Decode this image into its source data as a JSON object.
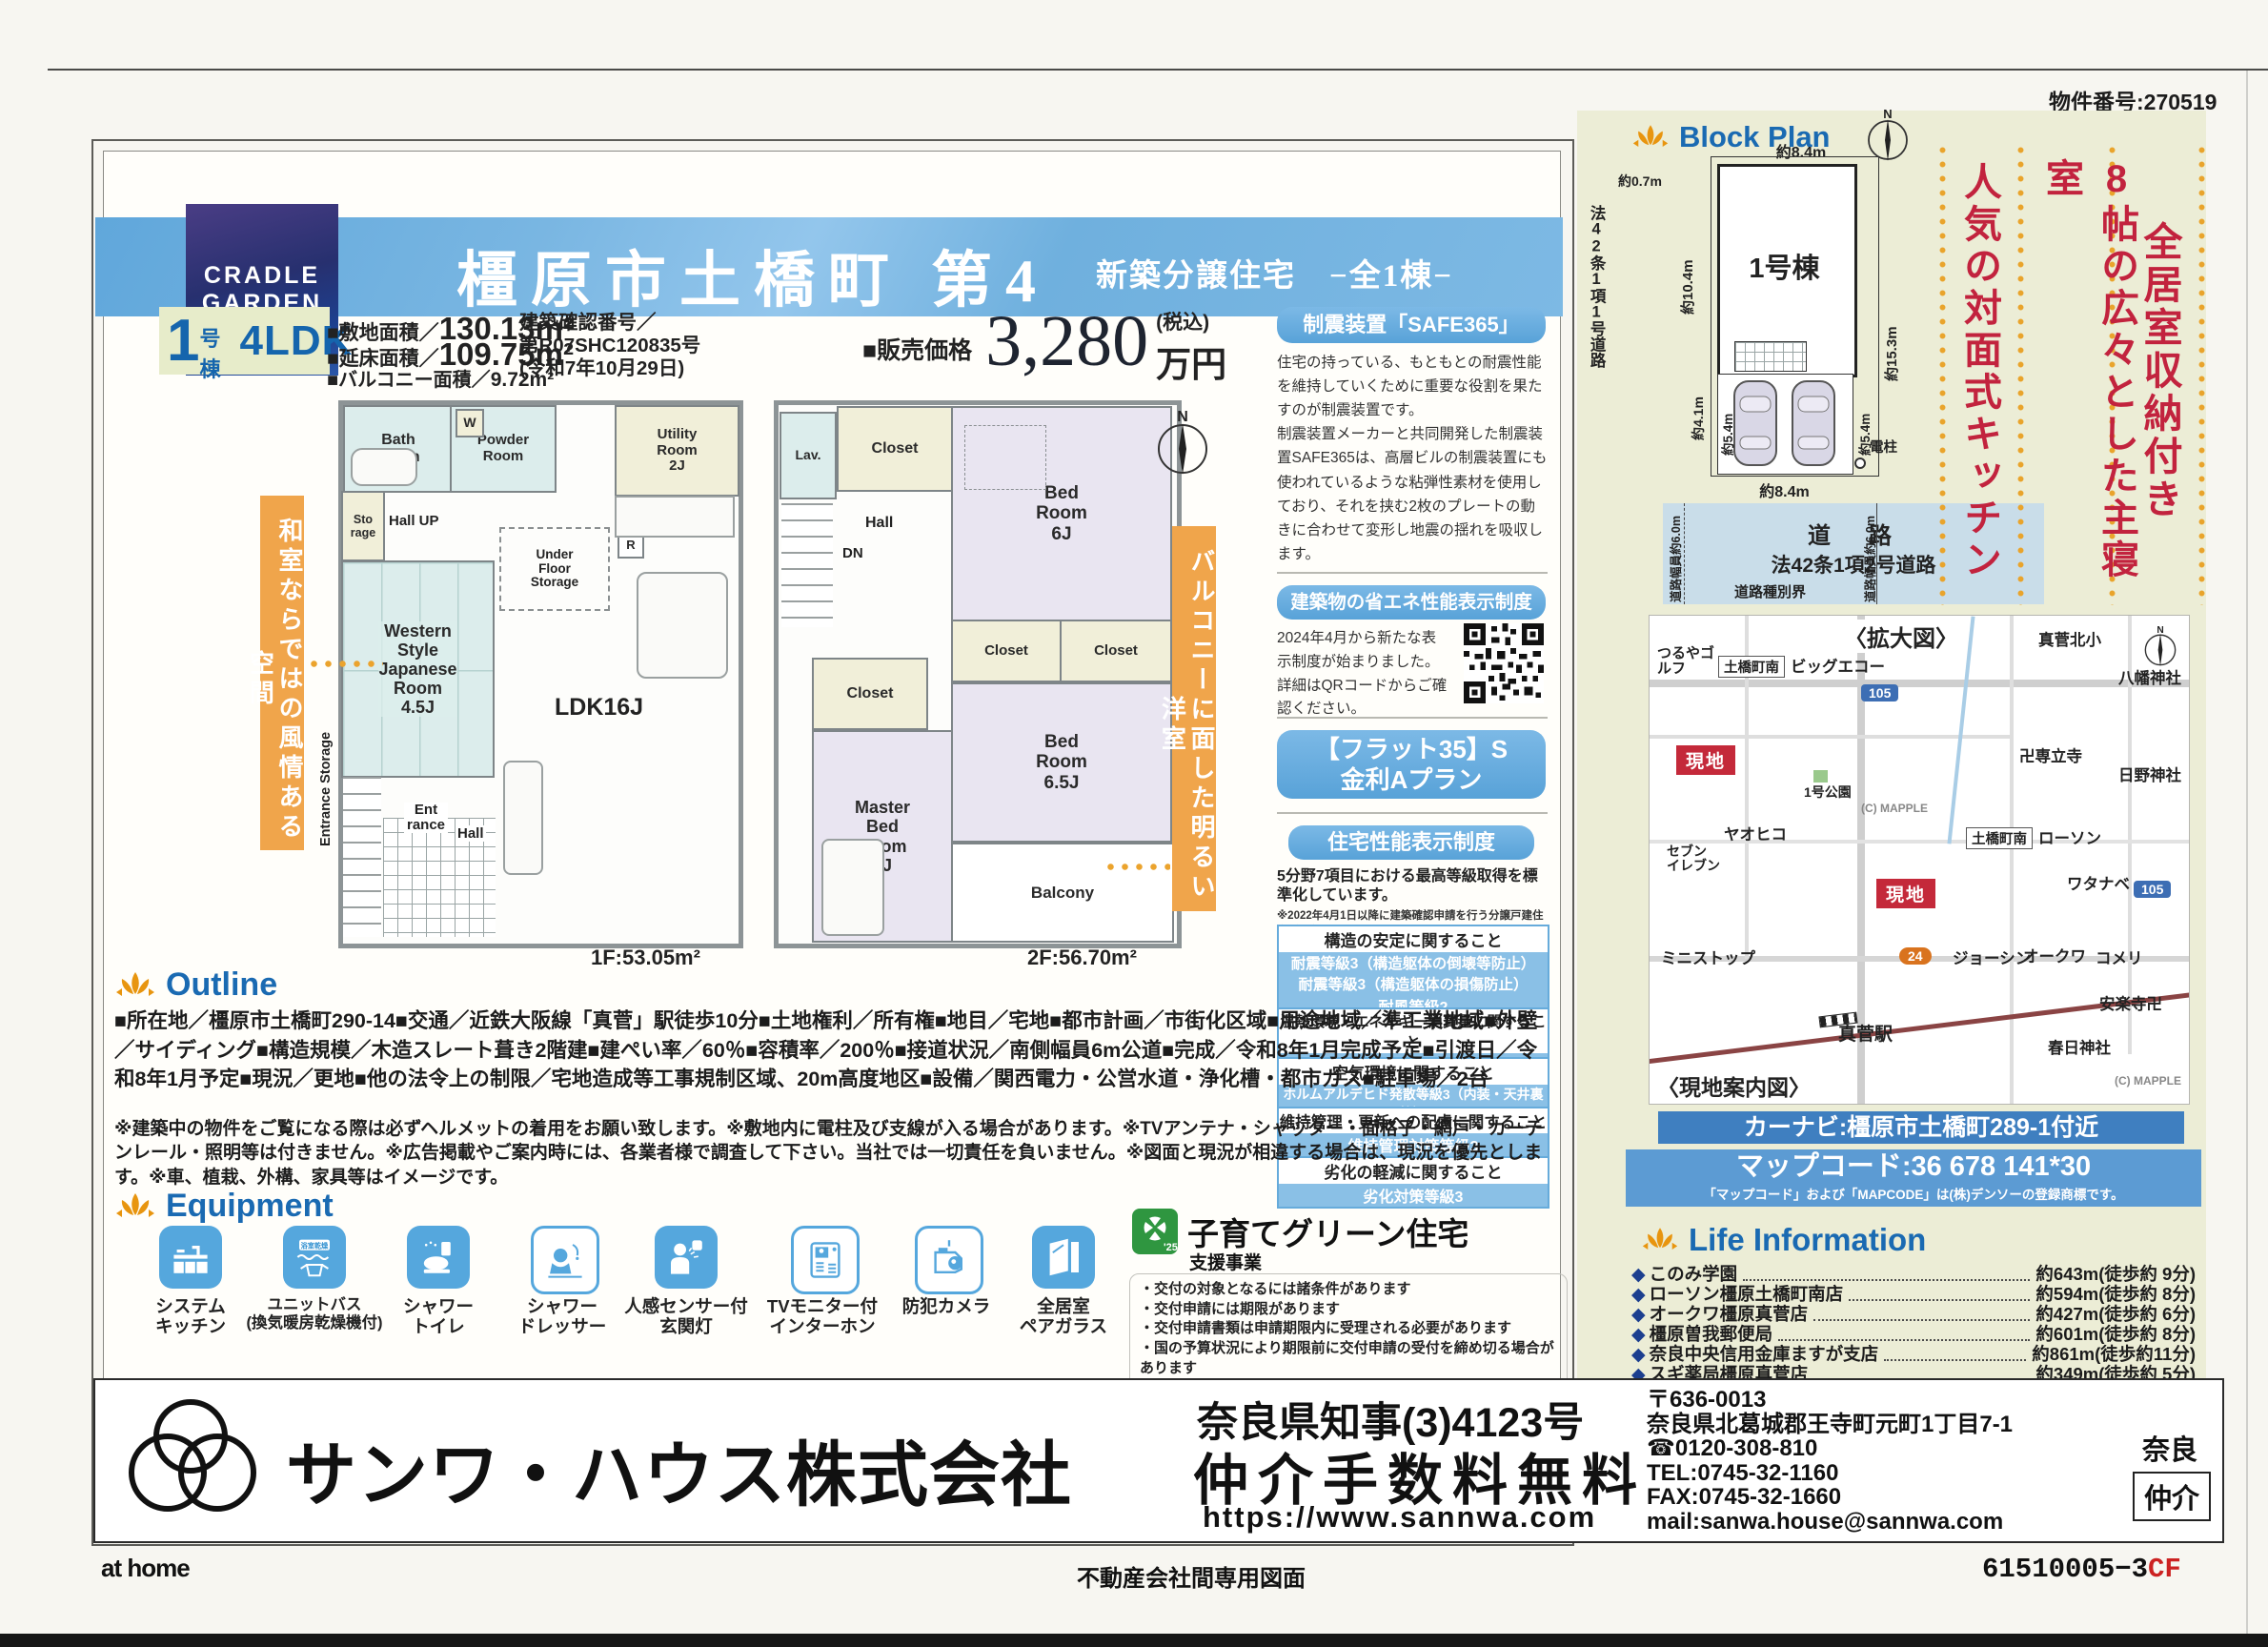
{
  "page": {
    "property_number": "物件番号:270519",
    "athome": "at home",
    "dedicated": "不動産会社間専用図面",
    "code": "61510005−3",
    "code_suffix": "CF"
  },
  "header": {
    "brand1": "CRADLE",
    "brand2": "GARDEN",
    "title": "橿原市土橋町 第4",
    "subtitle": "新築分譲住宅　−全1棟−"
  },
  "summary": {
    "unit_num": "1",
    "unit_label": "号棟",
    "plan": "4LDK",
    "area1_label": "■敷地面積／",
    "area1_value": "130.13m²",
    "area2_label": "■延床面積／",
    "area2_value": "109.75m²",
    "area3_label": "■バルコニー面積／",
    "area3_value": "9.72m²",
    "conf1": "建築確認番号／",
    "conf2": "第R07SHC120835号",
    "conf3": "(令和7年10月29日)",
    "price_label": "■販売価格",
    "price_value": "3,280",
    "price_tax": "(税込)",
    "price_unit": "万円"
  },
  "headlines": {
    "h1": "全居室収納付き",
    "h2": "8帖の広々とした主寝室",
    "h3": "人気の対面式キッチン"
  },
  "floorplan": {
    "banner_left": "和室ならではの風情ある空間",
    "banner_right": "バルコニーに面した明るい洋室",
    "north": "N",
    "f1_label": "1F:53.05m²",
    "f2_label": "2F:56.70m²",
    "f1": {
      "bath": "Bath\nRoom",
      "w": "W",
      "powder": "Powder\nRoom",
      "utility": "Utility\nRoom\n2J",
      "storage": "Sto\nrage",
      "hall_up": "Hall UP",
      "ufs": "Under\nFloor\nStorage",
      "r": "R",
      "japanese": "Western\nStyle\nJapanese\nRoom\n4.5J",
      "ldk": "LDK16J",
      "entrance": "Ent\nrance",
      "hall": "Hall",
      "ent_storage": "Entrance Storage"
    },
    "f2": {
      "lav": "Lav.",
      "closet1": "Closet",
      "hall": "Hall",
      "dn": "DN",
      "bed6": "Bed\nRoom\n6J",
      "closet2": "Closet",
      "closet3": "Closet",
      "closet4": "Closet",
      "bed65": "Bed\nRoom\n6.5J",
      "master": "Master\nBed\nRoom\n8J",
      "balcony": "Balcony"
    }
  },
  "safe365": {
    "title": "制震装置「SAFE365」",
    "body": "住宅の持っている、もともとの耐震性能を維持していくために重要な役割を果たすのが制震装置です。\n制震装置メーカーと共同開発した制震装置SAFE365は、高層ビルの制震装置にも使われているような粘弾性素材を使用しており、それを挟む2枚のプレートの動きに合わせて変形し地震の揺れを吸収します。"
  },
  "energy": {
    "title": "建築物の省エネ性能表示制度",
    "body": "2024年4月から新たな表示制度が始まりました。詳細はQRコードからご確認ください。"
  },
  "flat35": {
    "line1": "【フラット35】S",
    "line2": "金利Aプラン"
  },
  "performance": {
    "title": "住宅性能表示制度",
    "intro1": "5分野7項目における最高等級取得を標準化しています。",
    "intro2": "※2022年4月1日以降に建築確認申請を行う分譲戸建住宅が対象",
    "items": [
      {
        "head": "構造の安定に関すること",
        "grades": [
          "耐震等級3（構造躯体の倒壊等防止）",
          "耐震等級3（構造躯体の損傷防止）",
          "耐風等級2"
        ]
      },
      {
        "head": "温熱環境・エネルギー消費量に関すること",
        "grades": [
          "一次エネルギー消費量等級6"
        ]
      },
      {
        "head": "空気環境に関すること",
        "grades": [
          "ホルムアルデヒド発散等級3（内装・天井裏等）"
        ]
      },
      {
        "head": "維持管理・更新への配慮に関すること",
        "grades": [
          "維持管理対策等級3"
        ]
      },
      {
        "head": "劣化の軽減に関すること",
        "grades": [
          "劣化対策等級3"
        ]
      }
    ]
  },
  "outline": {
    "title": "Outline",
    "body": "■所在地／橿原市土橋町290-14■交通／近鉄大阪線「真菅」駅徒歩10分■土地権利／所有権■地目／宅地■都市計画／市街化区域■用途地域／準工業地域■外壁／サイディング■構造規模／木造スレート葺き2階建■建ぺい率／60％■容積率／200％■接道状況／南側幅員6m公道■完成／令和8年1月完成予定■引渡日／令和8年1月予定■現況／更地■他の法令上の制限／宅地造成等工事規制区域、20m高度地区■設備／関西電力・公営水道・浄化槽・都市ガス■駐車場／2台",
    "notes": "※建築中の物件をご覧になる際は必ずヘルメットの着用をお願い致します。※敷地内に電柱及び支線が入る場合があります。※TVアンテナ・シャッター・面格子・網戸・カーテンレール・照明等は付きません。※広告掲載やご案内時には、各業者様で調査して下さい。当社では一切責任を負いません。※図面と現況が相違する場合は、現況を優先とします。※車、植栽、外構、家具等はイメージです。"
  },
  "equipment": {
    "title": "Equipment",
    "items": [
      "システム\nキッチン",
      "ユニットバス\n(換気暖房乾燥機付)",
      "シャワー\nトイレ",
      "シャワー\nドレッサー",
      "人感センサー付\n玄関灯",
      "TVモニター付\nインターホン",
      "防犯カメラ",
      "全居室\nペアガラス"
    ],
    "bath_tag": "浴室乾燥"
  },
  "kosodate": {
    "badge": "'25",
    "title": "子育てグリーン住宅",
    "subtitle": "支援事業",
    "notes": "・交付の対象となるには諸条件があります\n・交付申請には期限があります\n・交付申請書類は申請期限内に受理される必要があります\n・国の予算状況により期限前に交付申請の受付を締め切る場合があります\n※ご不明な点は担当の営業所までお問い合わせください"
  },
  "blockplan": {
    "title": "Block Plan",
    "north": "N",
    "building": "1号棟",
    "dim_top": "約8.4m",
    "dim_offset": "約0.7m",
    "dim_left": "約10.4m",
    "dim_left2": "約4.1m",
    "dim_right": "約15.3m",
    "dim_p_left": "約5.4m",
    "dim_p_right": "約5.4m",
    "pole": "電柱",
    "dim_bottom": "約8.4m",
    "road_width_l": "道路幅員約6.0m",
    "road_width_r": "道路幅員約6.0m",
    "road1": "道　路",
    "road2": "法42条1項2号道路",
    "road_left": "法42条1項1号道路",
    "boundary": "道路種別界"
  },
  "map": {
    "enlarged": "〈拡大図〉",
    "guide": "〈現地案内図〉",
    "credit": "(C) MAPPLE",
    "genchi": "現地",
    "station": "真菅駅",
    "r105": "105",
    "r24": "24",
    "labels": [
      "つるやゴルフ",
      "土橋町南",
      "ビッグエコー",
      "真菅北小",
      "八幡神社",
      "1号公園",
      "卍専立寺",
      "日野神社",
      "ヤオヒコ",
      "セブン\nイレブン",
      "土橋町南",
      "ローソン",
      "ワタナベ",
      "ミニストップ",
      "ジョーシン",
      "オークワ",
      "コメリ",
      "安楽寺卍",
      "春日神社"
    ]
  },
  "carnav": {
    "line1": "カーナビ:橿原市土橋町289-1付近",
    "line2": "マップコード:36 678 141*30",
    "line3": "「マップコード」および「MAPCODE」は(株)デンソーの登録商標です。"
  },
  "life": {
    "title": "Life Information",
    "items": [
      {
        "name": "このみ学園",
        "dist": "約643m(徒歩約 9分)"
      },
      {
        "name": "ローソン橿原土橋町南店",
        "dist": "約594m(徒歩約 8分)"
      },
      {
        "name": "オークワ橿原真菅店",
        "dist": "約427m(徒歩約 6分)"
      },
      {
        "name": "橿原曽我郵便局",
        "dist": "約601m(徒歩約 8分)"
      },
      {
        "name": "奈良中央信用金庫ますが支店",
        "dist": "約861m(徒歩約11分)"
      },
      {
        "name": "スギ薬局橿原真菅店",
        "dist": "約349m(徒歩約 5分)"
      }
    ]
  },
  "footer": {
    "company": "サンワ・ハウス株式会社",
    "license": "奈良県知事(3)4123号",
    "fee": "仲介手数料無料",
    "url": "https://www.sannwa.com",
    "addr": "〒636-0013\n奈良県北葛城郡王寺町元町1丁目7-1\n☎0120-308-810\nTEL:0745-32-1160\nFAX:0745-32-1660\nmail:sanwa.house@sannwa.com",
    "pref": "奈良",
    "agency": "仲介"
  }
}
